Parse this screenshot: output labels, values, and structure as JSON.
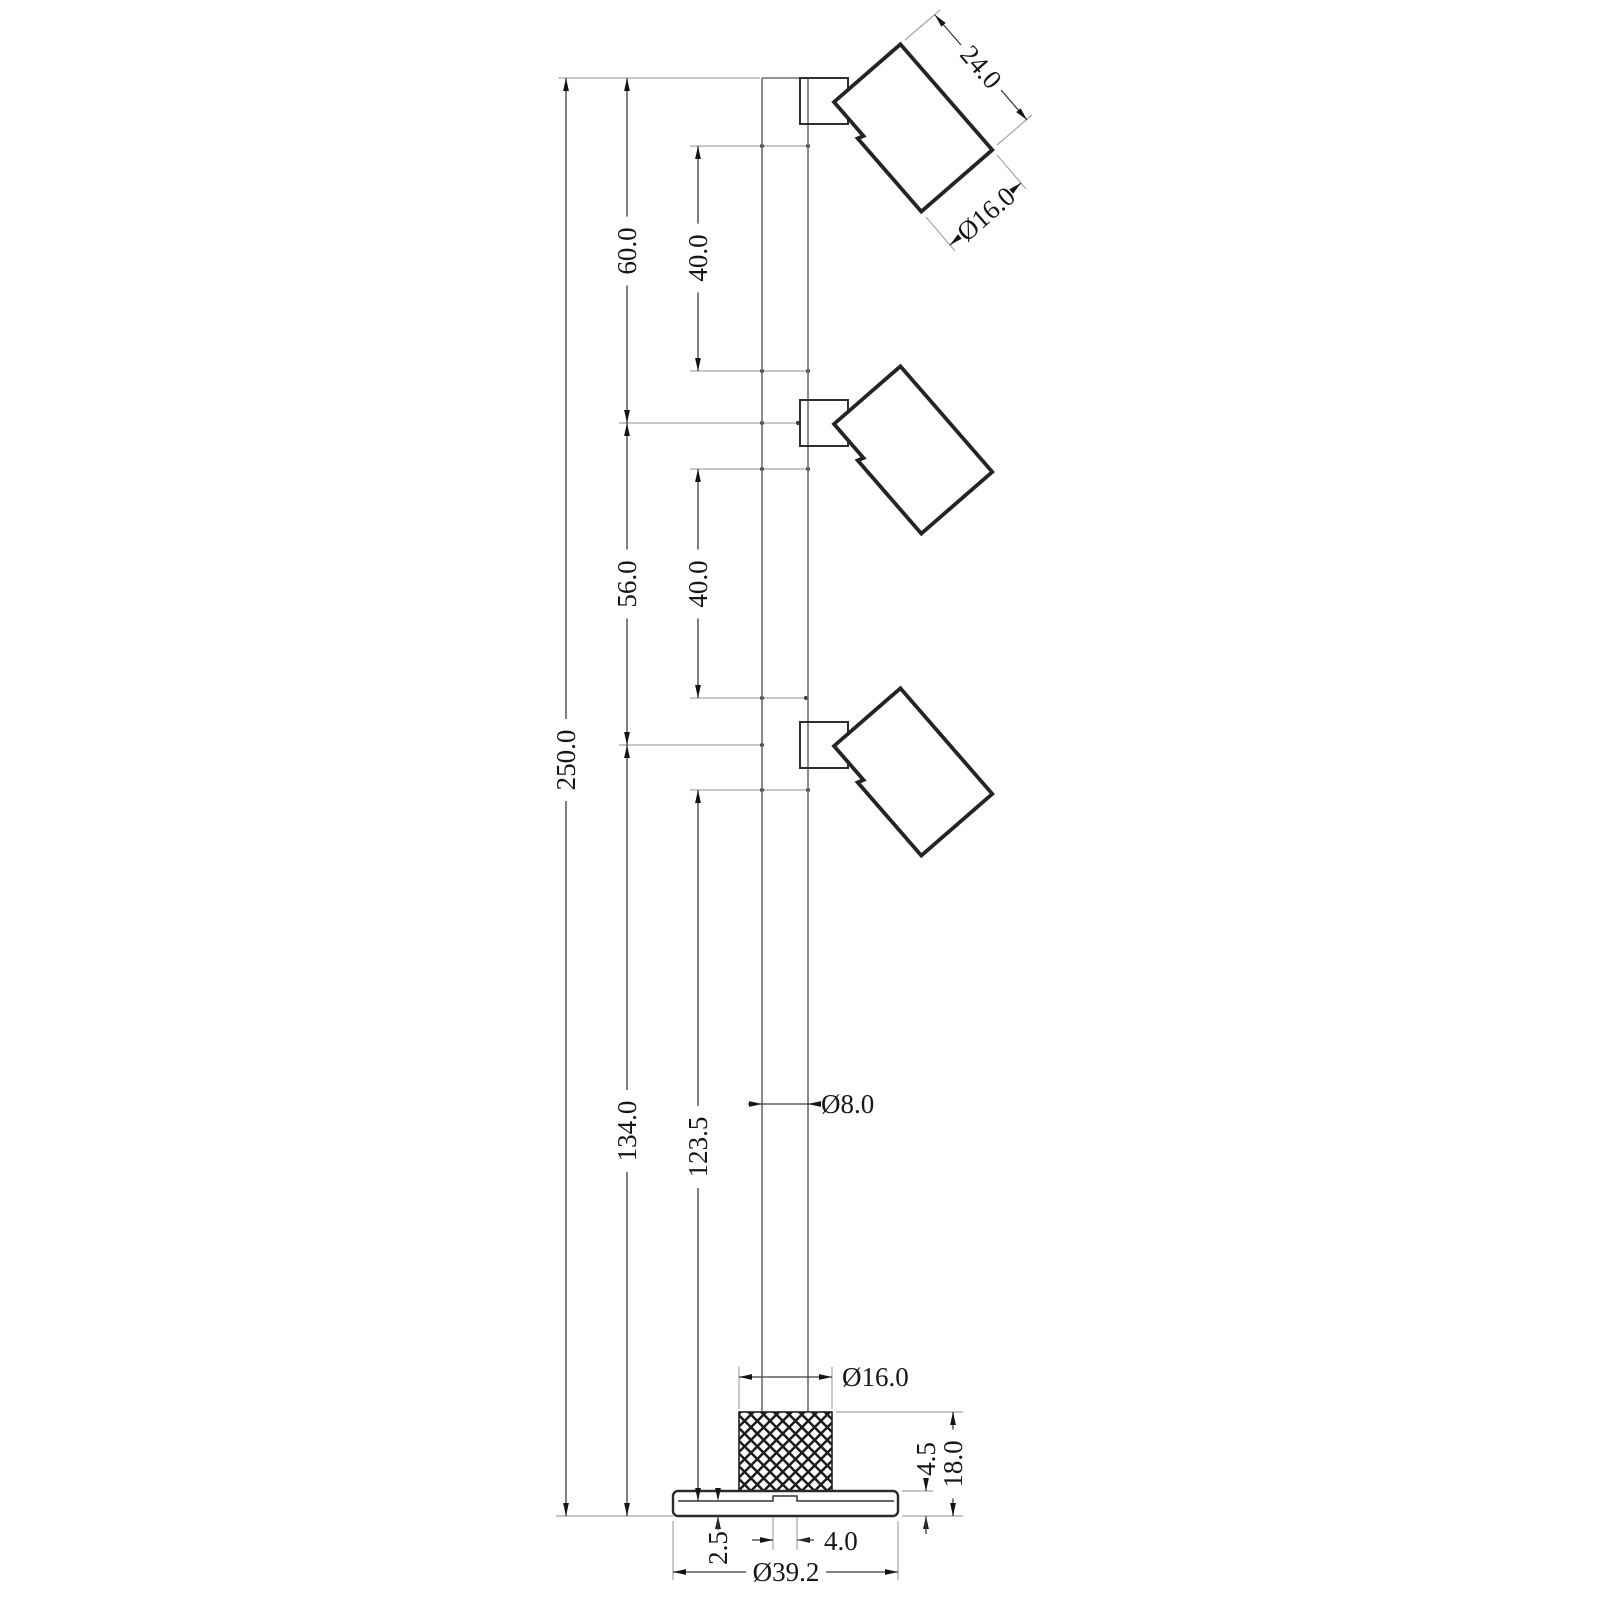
{
  "drawing": {
    "type": "technical-dimension-drawing",
    "subject": "Three-head spotlight floor pole, side elevation with dimensions",
    "parts": [
      {
        "id": "pole",
        "name": "vertical pole",
        "diameter_label": "Ø8.0"
      },
      {
        "id": "head-1",
        "name": "top spot head",
        "length_label": "24.0",
        "diameter_label": "Ø16.0"
      },
      {
        "id": "head-2",
        "name": "middle spot head"
      },
      {
        "id": "head-3",
        "name": "bottom spot head"
      },
      {
        "id": "knurled-collar",
        "name": "knurled base collar",
        "diameter_label": "Ø16.0"
      },
      {
        "id": "base-plate",
        "name": "base plate",
        "diameter_label": "Ø39.2"
      }
    ],
    "dimensions": [
      {
        "id": "total-height",
        "label": "250.0",
        "value": 250.0
      },
      {
        "id": "top-to-head2",
        "label": "60.0",
        "value": 60.0
      },
      {
        "id": "head1-head2-gap",
        "label": "40.0",
        "value": 40.0
      },
      {
        "id": "head2-head3",
        "label": "56.0",
        "value": 56.0
      },
      {
        "id": "head2-head3-gap",
        "label": "40.0",
        "value": 40.0
      },
      {
        "id": "head3-to-base",
        "label": "134.0",
        "value": 134.0
      },
      {
        "id": "head3-to-plate-recess",
        "label": "123.5",
        "value": 123.5
      },
      {
        "id": "pole-diameter",
        "label": "Ø8.0",
        "value": 8.0
      },
      {
        "id": "collar-diameter",
        "label": "Ø16.0",
        "value": 16.0
      },
      {
        "id": "head-length",
        "label": "24.0",
        "value": 24.0
      },
      {
        "id": "head-diameter",
        "label": "Ø16.0",
        "value": 16.0
      },
      {
        "id": "plate-thickness",
        "label": "4.5",
        "value": 4.5
      },
      {
        "id": "base-height",
        "label": "18.0",
        "value": 18.0
      },
      {
        "id": "plate-rim-thickness",
        "label": "2.5",
        "value": 2.5
      },
      {
        "id": "cable-notch-width",
        "label": "4.0",
        "value": 4.0
      },
      {
        "id": "plate-diameter",
        "label": "Ø39.2",
        "value": 39.2
      }
    ]
  }
}
